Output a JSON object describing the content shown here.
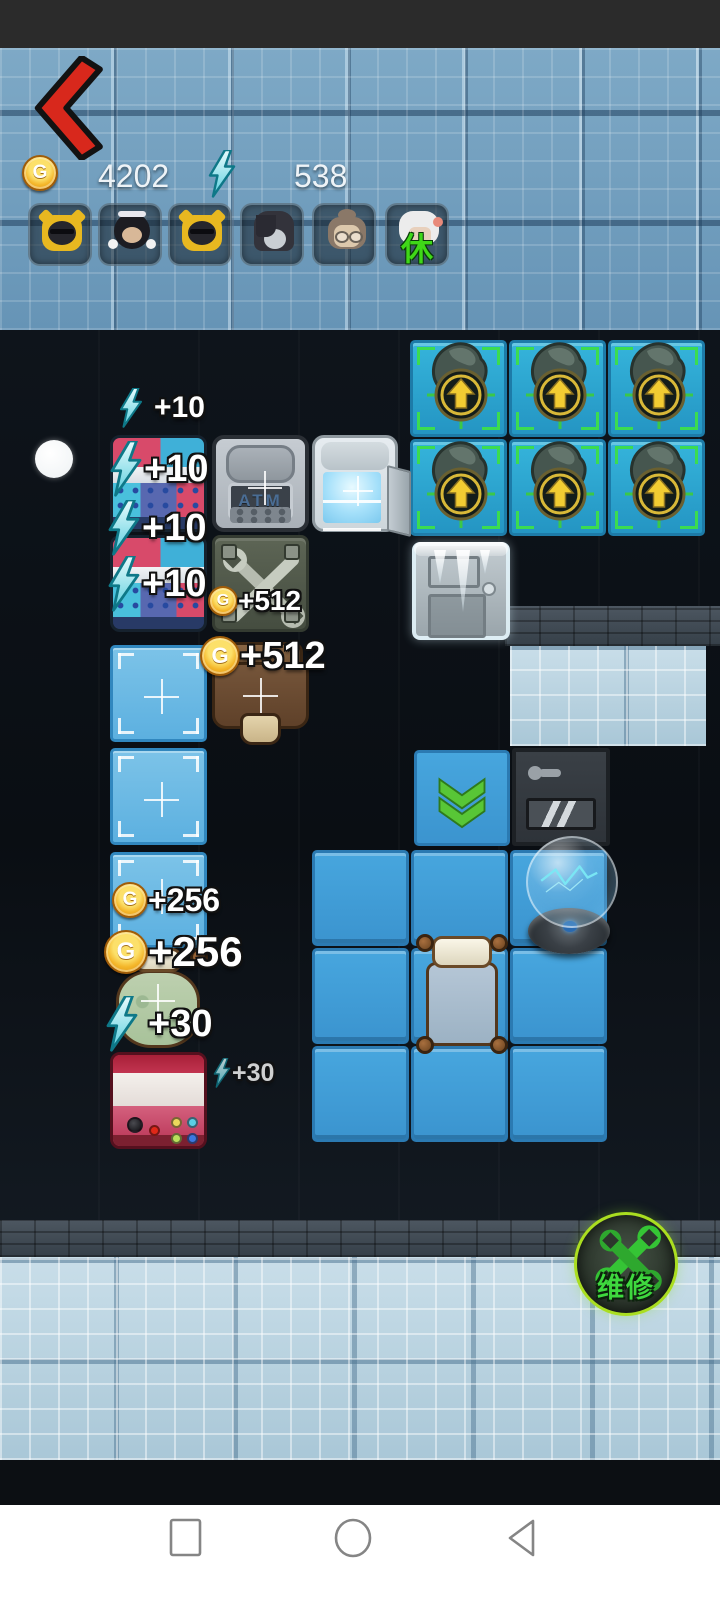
{
  "header": {
    "coins": "4202",
    "energy": "538",
    "coin_letter": "G"
  },
  "avatars": {
    "resting_status": "休"
  },
  "board": {
    "atm_text": "ATM",
    "labels": [
      {
        "kind": "energy",
        "value": "+10"
      },
      {
        "kind": "energy",
        "value": "+10"
      },
      {
        "kind": "energy",
        "value": "+10"
      },
      {
        "kind": "energy",
        "value": "+10"
      },
      {
        "kind": "coin",
        "value": "+512"
      },
      {
        "kind": "coin",
        "value": "+512"
      },
      {
        "kind": "coin",
        "value": "+256"
      },
      {
        "kind": "coin",
        "value": "+256"
      },
      {
        "kind": "energy",
        "value": "+30"
      },
      {
        "kind": "energy",
        "value": "+30"
      }
    ]
  },
  "repair": {
    "label": "维修"
  },
  "colors": {
    "accent_green": "#3fd818",
    "energy_cyan": "#4ad8e8",
    "coin_gold": "#f0b828",
    "tile_blue": "#3f9dd8",
    "back_red": "#d8281c"
  }
}
